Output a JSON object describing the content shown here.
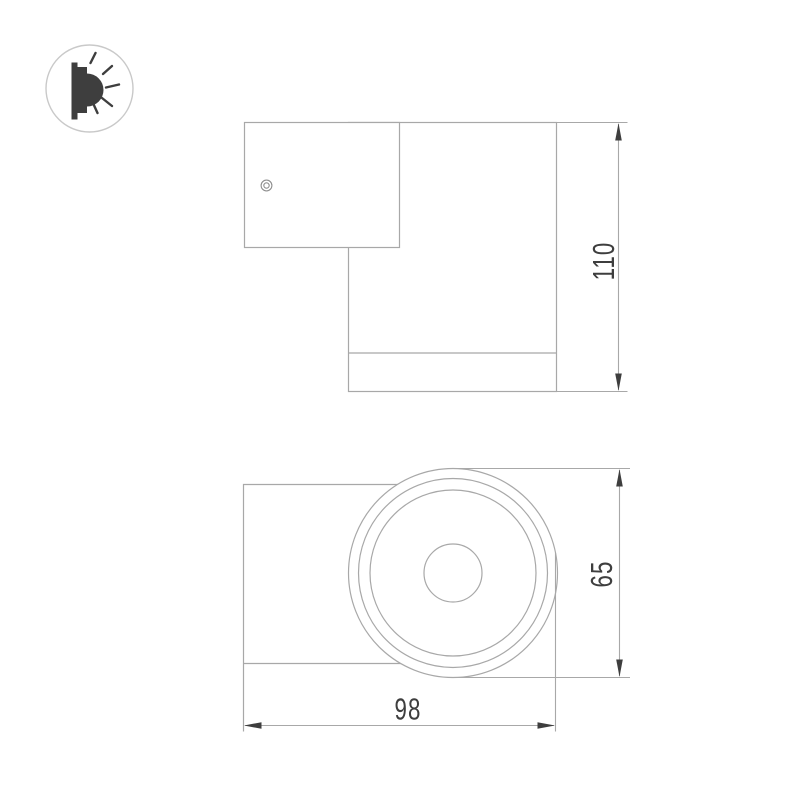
{
  "icon": {
    "name": "wall-lamp-light-beam-icon",
    "circle_color": "#c9c9c9",
    "glyph_color": "#3e3e3e"
  },
  "drawing": {
    "background": "#ffffff",
    "line_color": "#a8a8a8",
    "detail_line_color": "#8f8f8f",
    "accent_color": "#3e3e3e"
  },
  "dimensions": {
    "height": "110",
    "diameter": "65",
    "depth": "98"
  }
}
